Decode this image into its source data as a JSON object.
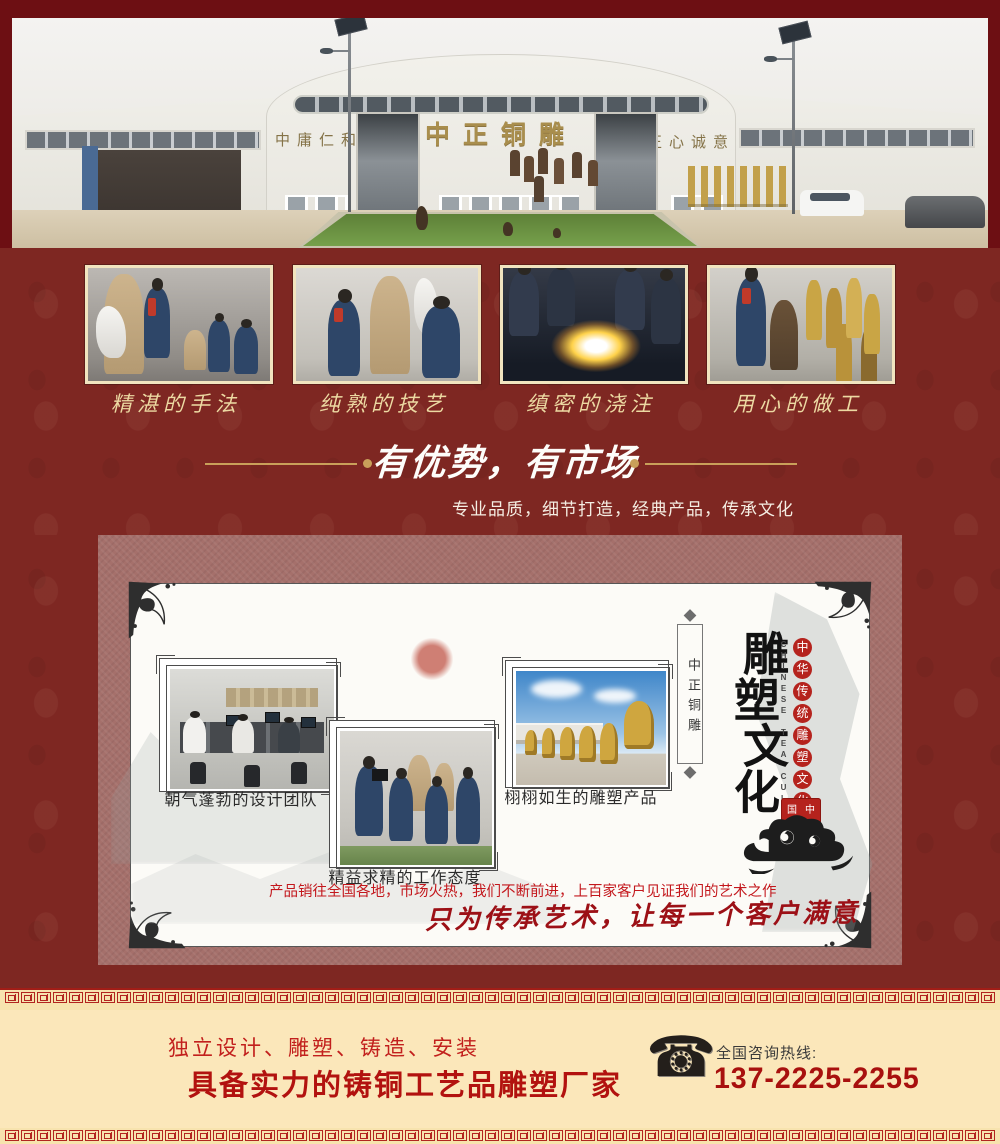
{
  "colors": {
    "deep_maroon": "#6d0f13",
    "band_red": "#7e2722",
    "panel_mauve": "#a5706b",
    "cream": "#fbe7ba",
    "accent_gold": "#c9a05a",
    "caption_gold": "#ecd9a2",
    "text_red": "#c2201d",
    "headline_red": "#b2120f",
    "phone_red": "#a8100e",
    "seal_red": "#b5231d",
    "slogan_red": "#9c1016"
  },
  "banner": {
    "sign_left": "中庸仁和",
    "sign_center": "中正铜雕",
    "sign_right": "正心诚意"
  },
  "process_photos": [
    {
      "caption": "精湛的手法"
    },
    {
      "caption": "纯熟的技艺"
    },
    {
      "caption": "缜密的浇注"
    },
    {
      "caption": "用心的做工"
    }
  ],
  "advantage": {
    "title": "有优势，有市场",
    "subtitle": "专业品质，细节打造，经典产品，传承文化"
  },
  "culture_card": {
    "photos": [
      {
        "caption": "朝气蓬勃的设计团队"
      },
      {
        "caption": "精益求精的工作态度"
      },
      {
        "caption": "栩栩如生的雕塑产品"
      }
    ],
    "plaque_text": "中正铜雕",
    "vertical_title": "雕塑文化",
    "vertical_subtitle": "中华传统雕塑文化",
    "vertical_english": "CHINESE TEA CULTURE",
    "seal_text": "中国文化",
    "market_text": "产品销往全国各地，市场火热，我们不断前进，上百家客户见证我们的艺术之作",
    "slogan": "只为传承艺术，让每一个客户满意"
  },
  "footer": {
    "services": "独立设计、雕塑、铸造、安装",
    "headline": "具备实力的铸铜工艺品雕塑厂家",
    "hotline_label": "全国咨询热线:",
    "phone": "137-2225-2255"
  }
}
